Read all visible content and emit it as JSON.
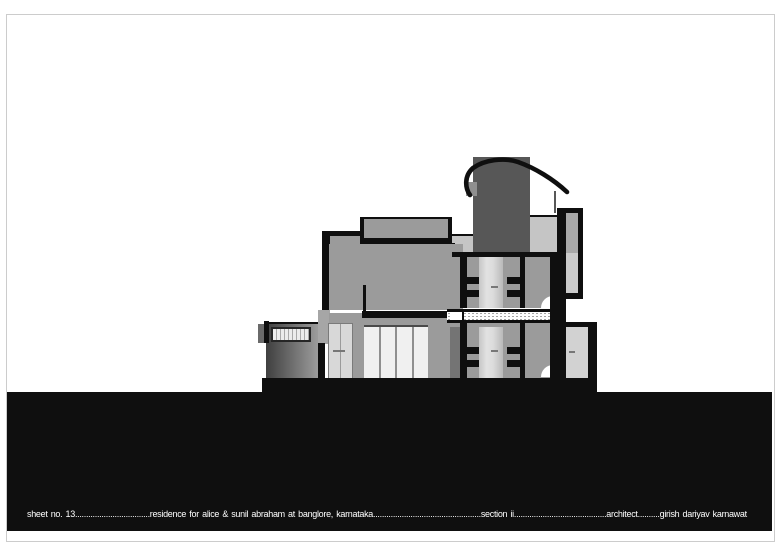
{
  "titlebar": {
    "segments": [
      {
        "label": "sheet no. 13",
        "leader": ".................................."
      },
      {
        "label": "residence for alice & sunil abraham at banglore, karnataka",
        "leader": "................................................."
      },
      {
        "label": "section ii",
        "leader": ".........................................."
      },
      {
        "label": "architect",
        "leader": ".........."
      },
      {
        "label": "girish dariyav karnawat",
        "leader": ""
      }
    ]
  },
  "colors": {
    "ink": "#0f0f0f",
    "wall": "#9b9b9b",
    "band": "#c5c5c5",
    "tower": "#575757",
    "glass": "#f0f0f0",
    "doorA": "#c6c6c6",
    "doorB": "#e2e2e2",
    "handle": "#777777",
    "frame": "#cccccc",
    "joint": "#a6a6a6",
    "stipple": "#9a9a9a",
    "wingdark": "#3f3f3f",
    "wingmid": "#9c9c9c",
    "panelhi": "#a9a9a9",
    "panello": "#cbcbcb",
    "darkwall": "#747474",
    "towerblock": "#8f8f8f"
  }
}
